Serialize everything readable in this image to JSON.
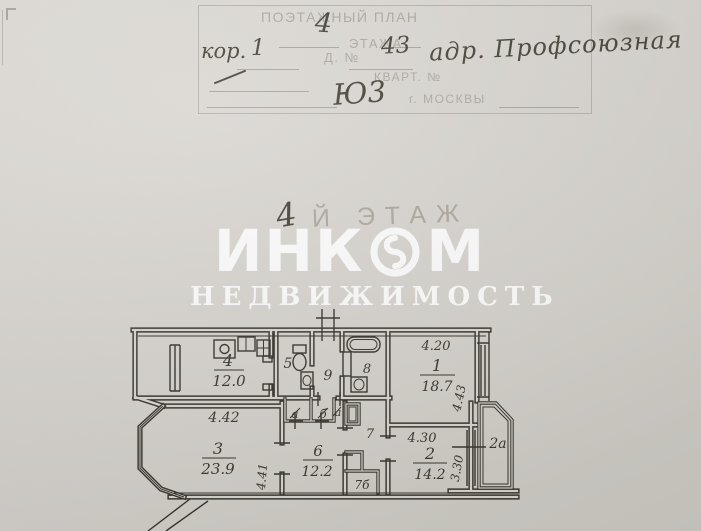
{
  "stamp": {
    "printed_title": "ПОЭТАЖНЫЙ ПЛАН",
    "printed_line2": "ЭТАЖА",
    "printed_house_label": "Д. №",
    "printed_kvart_label": "КВАРТ. №",
    "printed_city": "г. МОСКВЫ",
    "hw_floor_number": "4",
    "hw_building_label": "кор.",
    "hw_building_number": "1",
    "hw_house_number": "43",
    "hw_address": "адр. Профсоюзная",
    "hw_district_code": "Ю3"
  },
  "floor_label": {
    "handwritten_number": "4",
    "printed_suffix": "Й ЭТАЖ"
  },
  "watermark": {
    "brand_left": "ИНК",
    "brand_right": "М",
    "subtitle": "НЕДВИЖИМОСТЬ"
  },
  "plan": {
    "labels": {
      "room1_number": "1",
      "room1_area": "18.7",
      "room1_width": "4.20",
      "room1_depth": "4.43",
      "room2_number": "2",
      "room2_area": "14.2",
      "room2_width": "4.30",
      "room2_depth": "3.30",
      "room3_number": "3",
      "room3_area": "23.9",
      "room3_width": "4.42",
      "room3_depth": "4.41",
      "room4_number": "4",
      "room4_area": "12.0",
      "room5_number": "5",
      "room6_number": "6",
      "room6_area": "12.2",
      "room7_number": "7",
      "room7_closet": "7б",
      "room8_number": "8",
      "room9_number": "9",
      "closet_a": "а",
      "closet_b": "б",
      "closet_c": "а",
      "balcony": "2а"
    }
  }
}
